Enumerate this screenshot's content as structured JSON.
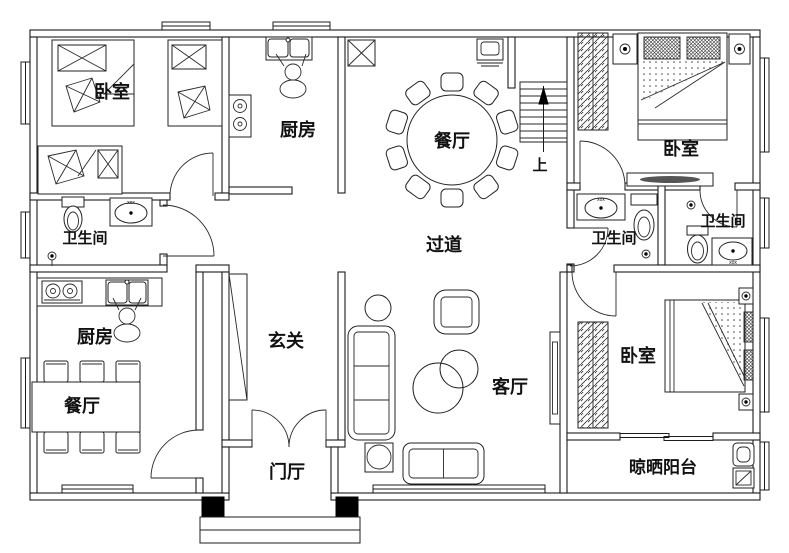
{
  "plan": {
    "rooms": [
      {
        "id": "bedroom_top_left",
        "label": "卧室"
      },
      {
        "id": "kitchen_top",
        "label": "厨房"
      },
      {
        "id": "dining_top",
        "label": "餐厅"
      },
      {
        "id": "bedroom_top_right",
        "label": "卧室"
      },
      {
        "id": "bathroom_left",
        "label": "卫生间"
      },
      {
        "id": "bathroom_middle",
        "label": "卫生间"
      },
      {
        "id": "bathroom_right",
        "label": "卫生间"
      },
      {
        "id": "kitchen_left",
        "label": "厨房"
      },
      {
        "id": "dining_left",
        "label": "餐厅"
      },
      {
        "id": "entrance_hall",
        "label": "玄关"
      },
      {
        "id": "corridor",
        "label": "过道"
      },
      {
        "id": "living_room",
        "label": "客厅"
      },
      {
        "id": "door_hall",
        "label": "门厅"
      },
      {
        "id": "bedroom_bottom_right",
        "label": "卧室"
      },
      {
        "id": "drying_balcony",
        "label": "晾晒阳台"
      }
    ],
    "stairs": {
      "up_label": "上"
    },
    "fixture_mark": "xox",
    "colors": {
      "line": "#1c1c1c",
      "background": "#ffffff",
      "column_fill": "#000000"
    }
  }
}
